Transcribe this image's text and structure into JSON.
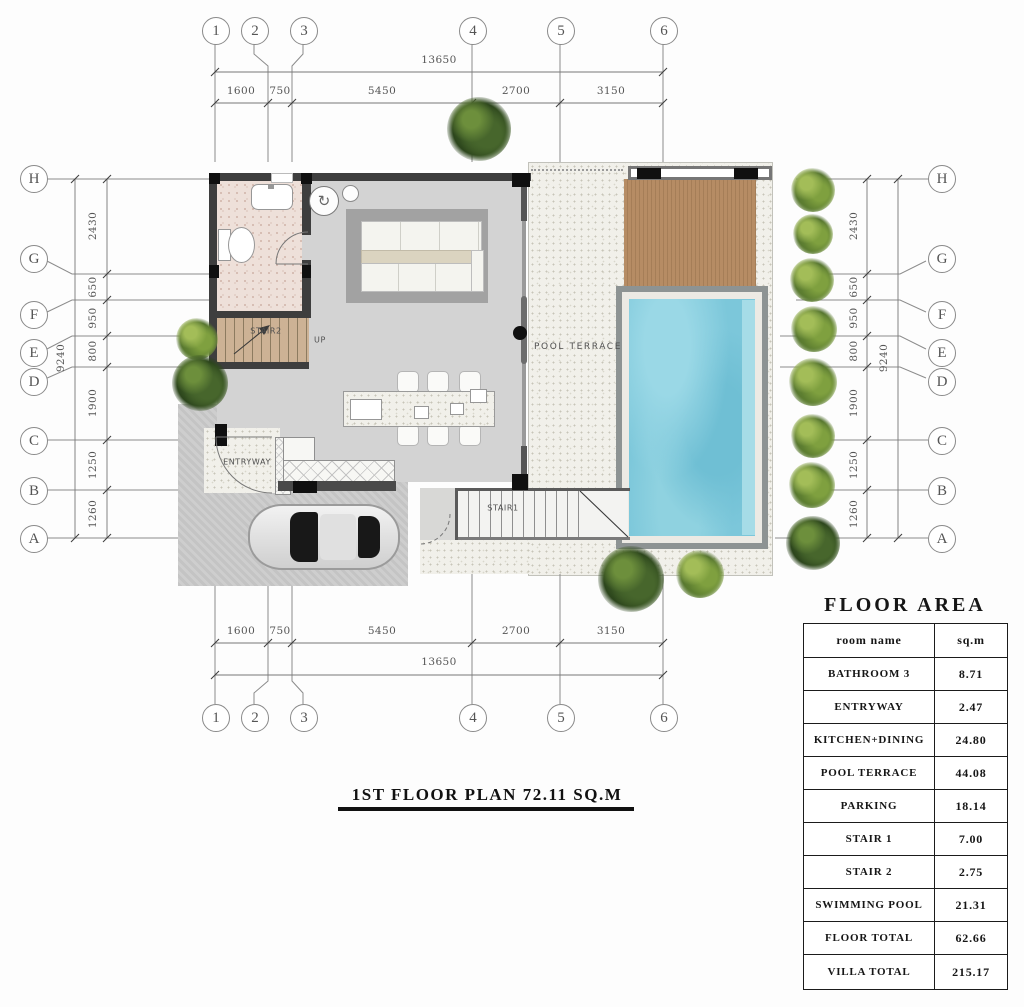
{
  "plan_title": "1ST FLOOR PLAN 72.11 SQ.M",
  "floor_area": {
    "title": "FLOOR AREA",
    "col_room": "room name",
    "col_sqm": "sq.m",
    "rows": [
      {
        "room": "BATHROOM 3",
        "sqm": "8.71"
      },
      {
        "room": "ENTRYWAY",
        "sqm": "2.47"
      },
      {
        "room": "KITCHEN+DINING",
        "sqm": "24.80"
      },
      {
        "room": "POOL TERRACE",
        "sqm": "44.08"
      },
      {
        "room": "PARKING",
        "sqm": "18.14"
      },
      {
        "room": "STAIR 1",
        "sqm": "7.00"
      },
      {
        "room": "STAIR 2",
        "sqm": "2.75"
      },
      {
        "room": "SWIMMING POOL",
        "sqm": "21.31"
      },
      {
        "room": "FLOOR TOTAL",
        "sqm": "62.66"
      },
      {
        "room": "VILLA TOTAL",
        "sqm": "215.17"
      }
    ]
  },
  "grid": {
    "cols": [
      "1",
      "2",
      "3",
      "4",
      "5",
      "6"
    ],
    "rows": [
      "H",
      "G",
      "F",
      "E",
      "D",
      "C",
      "B",
      "A"
    ],
    "h_overall": "13650",
    "h_segments": [
      "1600",
      "750",
      "5450",
      "2700",
      "3150"
    ],
    "v_overall": "9240",
    "v_segments": [
      "2430",
      "650",
      "950",
      "800",
      "1900",
      "1250",
      "1260"
    ]
  },
  "labels": {
    "pool_terrace": "POOL TERRACE",
    "entryway": "ENTRYWAY",
    "stair1": "STAIR1",
    "stair2": "STAIR2",
    "up": "UP"
  },
  "icons": {
    "washer": "↻"
  },
  "colors": {
    "wall": "#3e3e3e",
    "pool_water": "#7cc7da",
    "deck": "#b68c64",
    "plant_green": "#6f9140"
  }
}
